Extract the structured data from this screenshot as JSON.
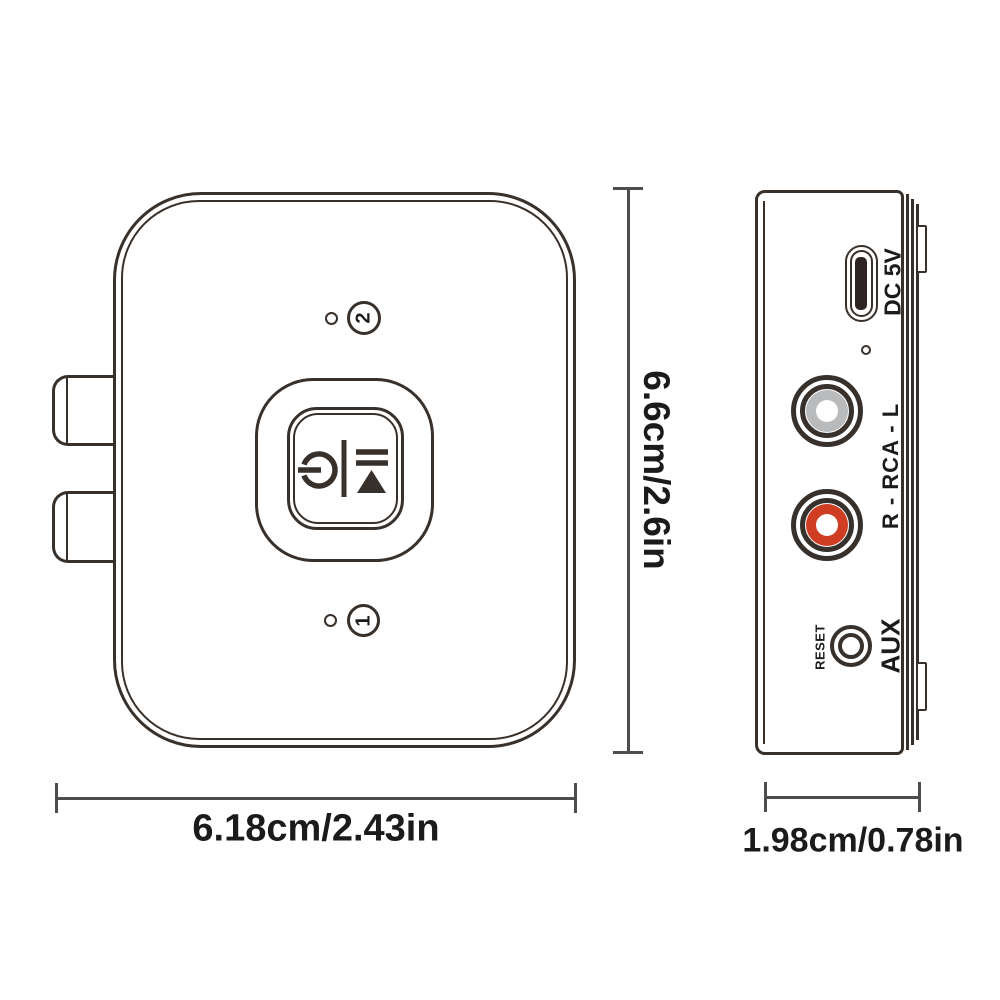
{
  "front_view": {
    "indicator_top": {
      "number": "2"
    },
    "indicator_bottom": {
      "number": "1"
    },
    "width_dimension": "6.18cm/2.43in",
    "height_dimension": "6.6cm/2.6in"
  },
  "side_view": {
    "usb_label": "DC 5V",
    "rca_label": "R - RCA - L",
    "reset_label": "RESET",
    "aux_label": "AUX",
    "depth_dimension": "1.98cm/0.78in"
  },
  "colors": {
    "line": "#38302b",
    "dim_line": "#4d4d4d",
    "text": "#1b1b1b",
    "rca_left_gray": "#b9babc",
    "rca_right_red": "#cf3e22",
    "usb_slot_dark": "#2d2522"
  }
}
